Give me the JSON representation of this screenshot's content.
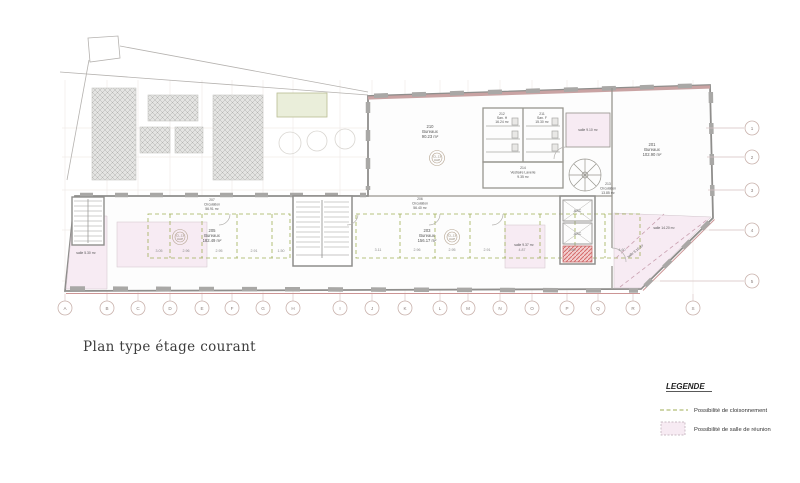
{
  "title": "Plan type étage courant",
  "legend": {
    "heading": "LEGENDE",
    "items": [
      {
        "symbol": "dashed-line",
        "label": "Possibilité de cloisonnement"
      },
      {
        "symbol": "pink-room",
        "label": "Possibilité de salle de réunion"
      }
    ]
  },
  "axes": {
    "bottom": [
      "A",
      "B",
      "C",
      "D",
      "E",
      "F",
      "G",
      "H",
      "I",
      "J",
      "K",
      "L",
      "M",
      "N",
      "O",
      "P",
      "Q",
      "R",
      "S"
    ],
    "right": [
      "1",
      "2",
      "3",
      "4",
      "5"
    ]
  },
  "rooms": {
    "office_top": {
      "num": "210",
      "name": "Bureaux",
      "area": "90.23 m²"
    },
    "san_h": {
      "num": "212",
      "name": "San. H",
      "area": "16.24 m²"
    },
    "san_f": {
      "num": "211",
      "name": "San. F",
      "area": "15.30 m²"
    },
    "vestiaire": {
      "num": "214",
      "name": "Vestiaire Laverie",
      "area": "9.35 m²"
    },
    "circ_right": {
      "num": "213",
      "name": "Circulation",
      "area": "13.85 m²"
    },
    "office_right": {
      "num": "201",
      "name": "Bureaux",
      "area": "102.90 m²"
    },
    "circ_left": {
      "num": "207",
      "name": "Circulation",
      "area": "56.91 m²"
    },
    "circ_mid": {
      "num": "206",
      "name": "Circulation",
      "area": "56.40 m²"
    },
    "office_left": {
      "num": "205",
      "name": "Bureaux",
      "area": "182.49 m²"
    },
    "office_mid": {
      "num": "203",
      "name": "Bureaux",
      "area": "156.17 m²"
    },
    "salle_left": "salle 5.30 m²",
    "salle_top_right": "salle 9.10 m²",
    "salle_mid": "salle 9.37 m²",
    "salle_br_1": "salle 14.20 m²",
    "salle_br_2": "salle 9.10 m²",
    "asc": "ASC"
  },
  "stamp": {
    "line1": "CL.13",
    "line2": "UAP"
  },
  "dims": [
    "3.05",
    "2.96",
    "2.95",
    "2.91",
    "1.50",
    "3.11",
    "2.96",
    "2.95",
    "2.91",
    "4.87",
    "2.80",
    "4.60"
  ],
  "colors": {
    "wall": "#8f8e8c",
    "window": "#a9a8a6",
    "pink_room": "#f7ebf3",
    "green_dash": "#9fae56",
    "red_hatch": "#d46a6a",
    "facade_line": "#cc9595",
    "axis_circle": "#c9b2ac"
  }
}
